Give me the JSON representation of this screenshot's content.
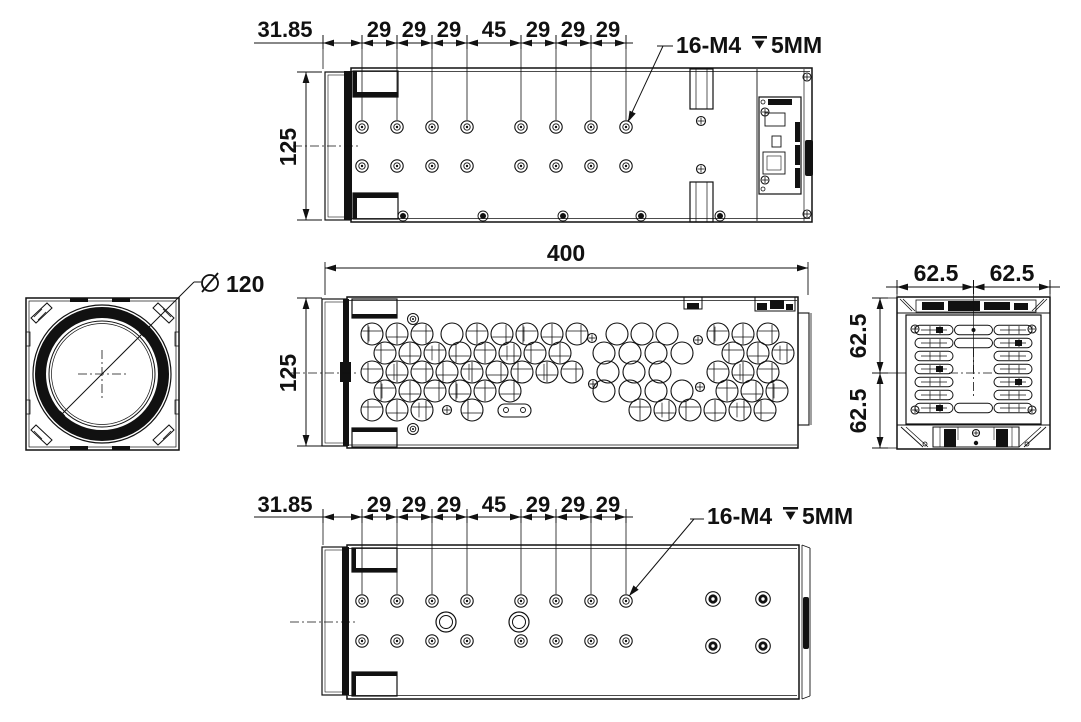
{
  "drawing": {
    "top_view": {
      "dims": [
        "31.85",
        "29",
        "29",
        "29",
        "45",
        "29",
        "29",
        "29"
      ],
      "height_dim": "125",
      "callout": {
        "thread": "16-M4",
        "depth": "5MM"
      }
    },
    "front_view": {
      "length_dim": "400",
      "height_dim": "125"
    },
    "lens_view": {
      "diameter_symbol": "⌀",
      "diameter": "120"
    },
    "rear_view": {
      "width_dims": [
        "62.5",
        "62.5"
      ],
      "height_dims": [
        "62.5",
        "62.5"
      ]
    },
    "bottom_view": {
      "dims": [
        "31.85",
        "29",
        "29",
        "29",
        "45",
        "29",
        "29",
        "29"
      ],
      "callout": {
        "thread": "16-M4",
        "depth": "5MM"
      }
    }
  },
  "colors": {
    "line": "#111111",
    "background": "#ffffff"
  }
}
